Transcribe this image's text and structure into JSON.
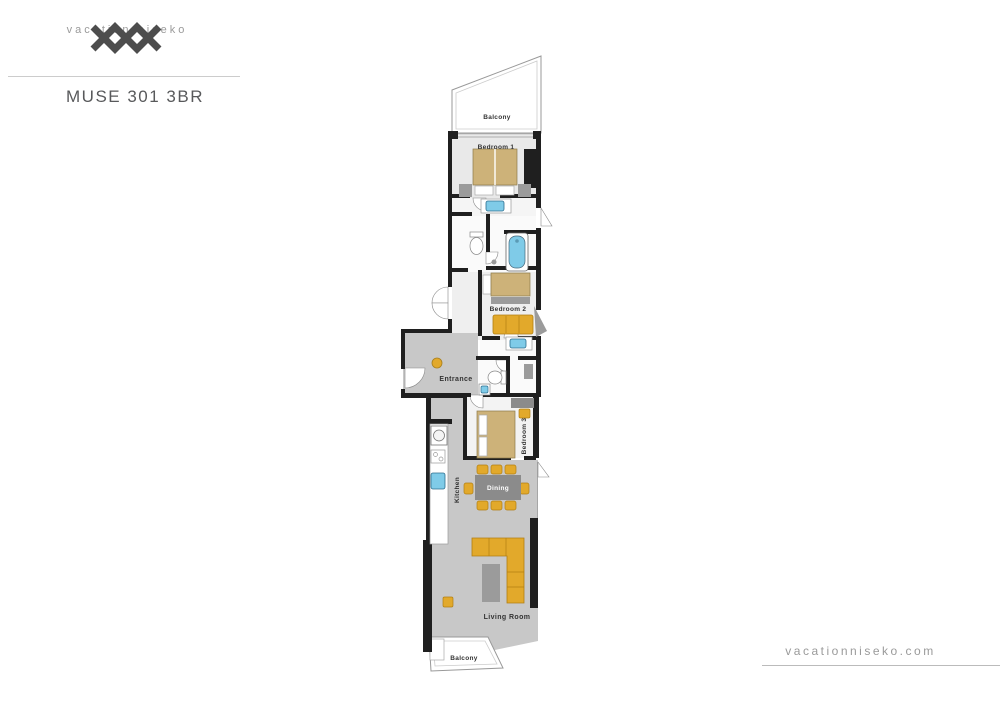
{
  "header": {
    "brand": "vacation niseko",
    "title": "MUSE 301 3BR"
  },
  "footer": {
    "website": "vacationniseko.com"
  },
  "floorplan": {
    "labels": {
      "balcony_top": "Balcony",
      "bedroom1": "Bedroom 1",
      "bedroom2": "Bedroom 2",
      "bedroom3": "Bedroom 3",
      "entrance": "Entrance",
      "kitchen": "Kitchen",
      "dining": "Dining",
      "living_room": "Living Room",
      "balcony_bottom": "Balcony"
    },
    "colors": {
      "wall": "#1f1f1f",
      "floor_light": "#e9e9e9",
      "floor_mid": "#c8c8c8",
      "room_white": "#fafafa",
      "bed_tan": "#cdb279",
      "accent_gold": "#e2a92b",
      "fixture_blue": "#7fcbe8",
      "furniture_gray": "#9b9b9b",
      "label_dark": "#333333",
      "brand_gray": "#4d4d4d",
      "muted_gray": "#9a9a9a"
    }
  }
}
